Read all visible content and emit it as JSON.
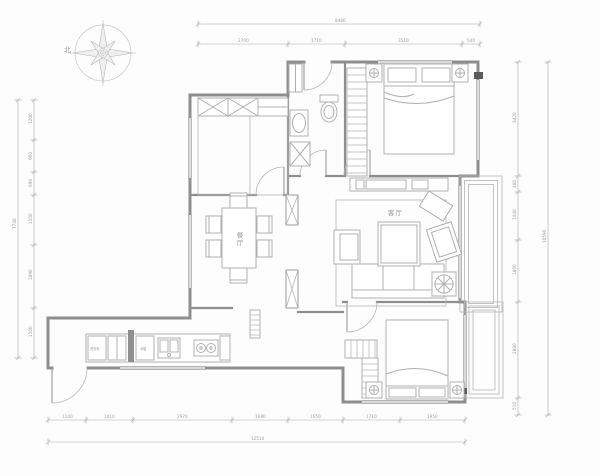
{
  "compass": {
    "label": "北"
  },
  "rooms": {
    "living": "客厅",
    "dining": "餐厅"
  },
  "appliances": {
    "washer": "洗衣机",
    "fridge": "冰箱"
  },
  "colors": {
    "wall": "#8e8e8e",
    "furniture": "#b0b0b0",
    "dimension": "#a0a0a0",
    "background": "#fdfdfd",
    "flue_marker": "#5a5a5a"
  },
  "dimensions": {
    "top": {
      "total": "8460",
      "segments": [
        "2700",
        "1710",
        "3510",
        "540"
      ]
    },
    "left": {
      "total": "7740",
      "segments": [
        "1200",
        "960",
        "690",
        "1500",
        "1890",
        "1500"
      ]
    },
    "right": {
      "total": "10590",
      "segments": [
        "3420",
        "480",
        "1440",
        "1860",
        "2880",
        "510"
      ]
    },
    "bottom": {
      "total": "12510",
      "segments": [
        "1140",
        "1410",
        "2970",
        "1680",
        "1650",
        "1710",
        "1950"
      ]
    }
  }
}
